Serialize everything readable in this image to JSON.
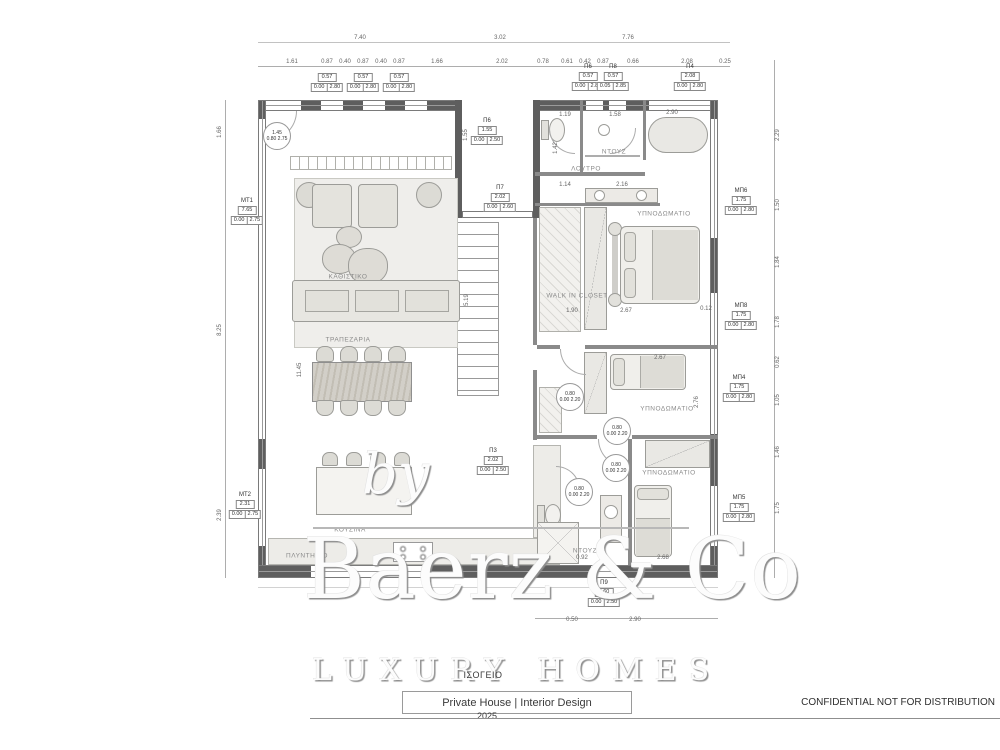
{
  "watermark": {
    "by": "by",
    "brand": "Baerz & Co",
    "tagline": "LUXURY HOMES"
  },
  "title_block": {
    "floor": "ΙΣΟΓΕΙΟ",
    "project": "Private House | Interior Design",
    "year": "2025"
  },
  "footer": {
    "confidential": "CONFIDENTIAL NOT FOR DISTRIBUTION"
  },
  "room_labels": [
    {
      "t": "ΚΑΘΙΣΤΙΚΟ",
      "x": 348,
      "y": 277
    },
    {
      "t": "ΤΡΑΠΕΖΑΡΙΑ",
      "x": 348,
      "y": 340
    },
    {
      "t": "ΚΟΥΖΙΝΑ",
      "x": 350,
      "y": 530
    },
    {
      "t": "ΠΛΥΝΤΗΡΙΟ",
      "x": 307,
      "y": 556
    },
    {
      "t": "ΝΤΟΥΖ",
      "x": 614,
      "y": 152
    },
    {
      "t": "ΛΟΥΤΡΟ",
      "x": 586,
      "y": 169
    },
    {
      "t": "ΥΠΝΟΔΩΜΑΤΙΟ",
      "x": 664,
      "y": 214
    },
    {
      "t": "WALK IN CLOSET",
      "x": 577,
      "y": 296
    },
    {
      "t": "ΥΠΝΟΔΩΜΑΤΙΟ",
      "x": 667,
      "y": 409
    },
    {
      "t": "ΥΠΝΟΔΩΜΑΤΙΟ",
      "x": 669,
      "y": 473
    },
    {
      "t": "ΝΤΟΥΖ",
      "x": 585,
      "y": 551
    }
  ],
  "dims": [
    {
      "t": "7.40",
      "x": 360,
      "y": 38
    },
    {
      "t": "3.02",
      "x": 500,
      "y": 38
    },
    {
      "t": "7.76",
      "x": 628,
      "y": 38
    },
    {
      "t": "1.61",
      "x": 292,
      "y": 62
    },
    {
      "t": "0.87",
      "x": 327,
      "y": 62
    },
    {
      "t": "0.40",
      "x": 345,
      "y": 62
    },
    {
      "t": "0.87",
      "x": 363,
      "y": 62
    },
    {
      "t": "0.40",
      "x": 381,
      "y": 62
    },
    {
      "t": "0.87",
      "x": 399,
      "y": 62
    },
    {
      "t": "1.66",
      "x": 437,
      "y": 62
    },
    {
      "t": "2.02",
      "x": 502,
      "y": 62
    },
    {
      "t": "0.78",
      "x": 543,
      "y": 62
    },
    {
      "t": "0.61",
      "x": 567,
      "y": 62
    },
    {
      "t": "0.42",
      "x": 585,
      "y": 62
    },
    {
      "t": "0.87",
      "x": 603,
      "y": 62
    },
    {
      "t": "0.66",
      "x": 633,
      "y": 62
    },
    {
      "t": "2.08",
      "x": 687,
      "y": 62
    },
    {
      "t": "0.25",
      "x": 725,
      "y": 62
    },
    {
      "t": "1.19",
      "x": 565,
      "y": 115
    },
    {
      "t": "1.58",
      "x": 615,
      "y": 115
    },
    {
      "t": "2.90",
      "x": 672,
      "y": 113
    },
    {
      "t": "1.14",
      "x": 565,
      "y": 185
    },
    {
      "t": "2.16",
      "x": 622,
      "y": 185
    },
    {
      "t": "1.90",
      "x": 572,
      "y": 311
    },
    {
      "t": "2.67",
      "x": 626,
      "y": 311
    },
    {
      "t": "0.12",
      "x": 706,
      "y": 309
    },
    {
      "t": "2.67",
      "x": 660,
      "y": 358
    },
    {
      "t": "0.92",
      "x": 582,
      "y": 558
    },
    {
      "t": "2.68",
      "x": 663,
      "y": 558
    },
    {
      "t": "0.50",
      "x": 572,
      "y": 620
    },
    {
      "t": "2.90",
      "x": 635,
      "y": 620
    },
    {
      "t": "1.66",
      "x": 220,
      "y": 132,
      "rot": 1
    },
    {
      "t": "8.25",
      "x": 220,
      "y": 330,
      "rot": 1
    },
    {
      "t": "2.39",
      "x": 220,
      "y": 515,
      "rot": 1
    },
    {
      "t": "2.29",
      "x": 778,
      "y": 135,
      "rot": 1
    },
    {
      "t": "1.50",
      "x": 778,
      "y": 205,
      "rot": 1
    },
    {
      "t": "1.84",
      "x": 778,
      "y": 262,
      "rot": 1
    },
    {
      "t": "1.78",
      "x": 778,
      "y": 322,
      "rot": 1
    },
    {
      "t": "0.62",
      "x": 778,
      "y": 362,
      "rot": 1
    },
    {
      "t": "1.05",
      "x": 778,
      "y": 400,
      "rot": 1
    },
    {
      "t": "1.46",
      "x": 778,
      "y": 452,
      "rot": 1
    },
    {
      "t": "1.75",
      "x": 778,
      "y": 508,
      "rot": 1
    },
    {
      "t": "1.55",
      "x": 466,
      "y": 135,
      "rot": 1
    },
    {
      "t": "5.19",
      "x": 467,
      "y": 300,
      "rot": 1
    },
    {
      "t": "11.45",
      "x": 300,
      "y": 370,
      "rot": 1
    },
    {
      "t": "1.42",
      "x": 556,
      "y": 148,
      "rot": 1
    },
    {
      "t": "2.76",
      "x": 697,
      "y": 402,
      "rot": 1
    }
  ],
  "window_tags": [
    {
      "label": "",
      "v": "0.57",
      "r1": "0.00",
      "r2": "2.80",
      "x": 327,
      "y": 72
    },
    {
      "label": "",
      "v": "0.57",
      "r1": "0.00",
      "r2": "2.80",
      "x": 363,
      "y": 72
    },
    {
      "label": "",
      "v": "0.57",
      "r1": "0.00",
      "r2": "2.80",
      "x": 399,
      "y": 72
    },
    {
      "label": "Π6",
      "v": "0.57",
      "r1": "0.00",
      "r2": "2.80",
      "x": 588,
      "y": 64
    },
    {
      "label": "Π8",
      "v": "0.57",
      "r1": "0.05",
      "r2": "2.85",
      "x": 613,
      "y": 64
    },
    {
      "label": "Π4",
      "v": "2.08",
      "r1": "0.00",
      "r2": "2.80",
      "x": 690,
      "y": 64
    },
    {
      "label": "Π6",
      "v": "1.55",
      "r1": "0.00",
      "r2": "2.50",
      "x": 487,
      "y": 118
    },
    {
      "label": "Π7",
      "v": "2.02",
      "r1": "0.00",
      "r2": "2.60",
      "x": 500,
      "y": 185
    },
    {
      "label": "Π3",
      "v": "2.02",
      "r1": "0.00",
      "r2": "2.50",
      "x": 493,
      "y": 448
    },
    {
      "label": "Π9",
      "v": "0.60",
      "r1": "0.00",
      "r2": "2.50",
      "x": 604,
      "y": 580
    }
  ],
  "side_tags": [
    {
      "label": "ΜΤ1",
      "v": "7.65",
      "r1": "0.00",
      "r2": "2.75",
      "x": 247,
      "y": 198
    },
    {
      "label": "ΜΤ2",
      "v": "2.31",
      "r1": "0.00",
      "r2": "2.75",
      "x": 245,
      "y": 492
    },
    {
      "label": "ΜΠ6",
      "v": "1.75",
      "r1": "0.00",
      "r2": "2.80",
      "x": 741,
      "y": 188
    },
    {
      "label": "ΜΠ8",
      "v": "1.75",
      "r1": "0.00",
      "r2": "2.80",
      "x": 741,
      "y": 303
    },
    {
      "label": "ΜΠ4",
      "v": "1.75",
      "r1": "0.00",
      "r2": "2.80",
      "x": 739,
      "y": 375
    },
    {
      "label": "ΜΠ5",
      "v": "1.75",
      "r1": "0.00",
      "r2": "2.80",
      "x": 739,
      "y": 495
    }
  ],
  "door_tags": [
    {
      "v1": "1.45",
      "v2": "0.80 2.75",
      "x": 277,
      "y": 136
    },
    {
      "v1": "0.80",
      "v2": "0.00 2.20",
      "x": 570,
      "y": 397
    },
    {
      "v1": "0.80",
      "v2": "0.00 2.20",
      "x": 617,
      "y": 431
    },
    {
      "v1": "0.80",
      "v2": "0.00 2.20",
      "x": 616,
      "y": 468
    },
    {
      "v1": "0.80",
      "v2": "0.00 2.20",
      "x": 579,
      "y": 492
    }
  ]
}
